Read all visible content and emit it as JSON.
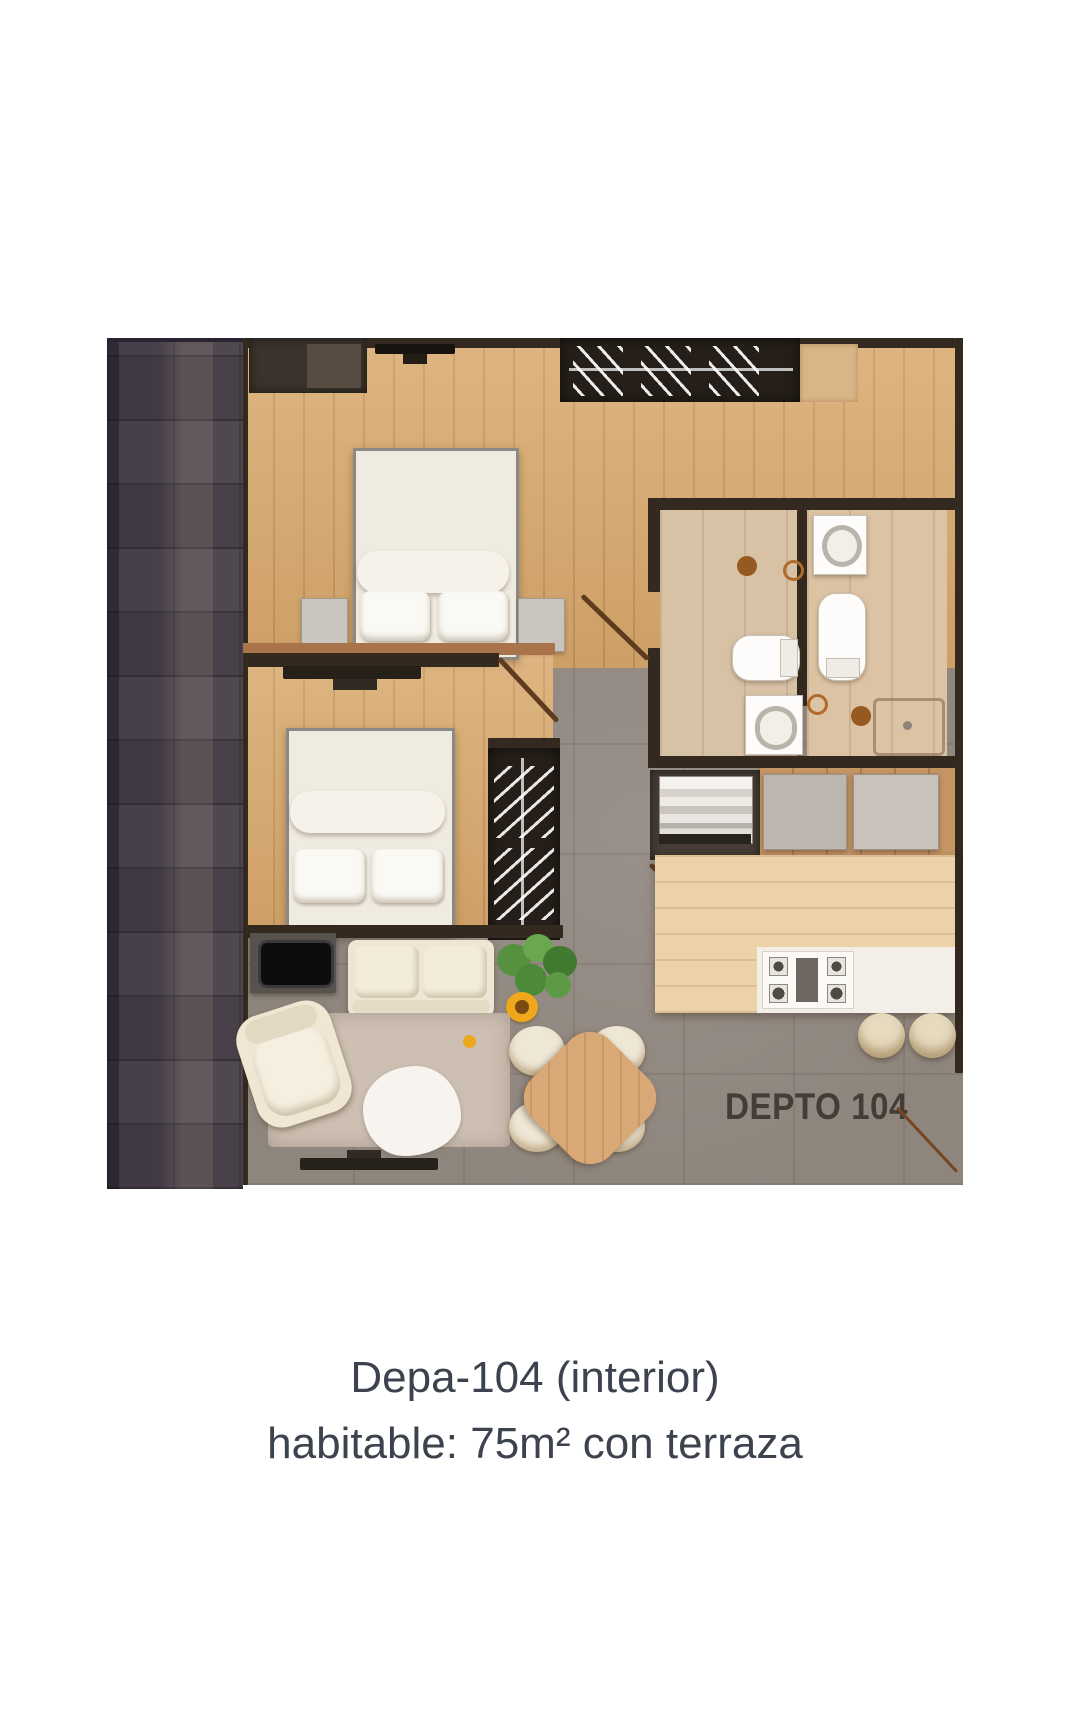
{
  "plan": {
    "unit_label": "DEPTO 104",
    "palette": {
      "wood_floor": "#d9a96c",
      "concrete_floor": "#8e857d",
      "bath_tile": "#d8c2a6",
      "wall": "#33291f",
      "terrace_dark": "#4d4550",
      "island_counter": "#ecd2a9",
      "marble": "#f3efe8",
      "plant_green": "#55913f",
      "flower_yellow": "#efa71d",
      "door_brown": "#5e3a1f"
    },
    "rooms": [
      "bedroom-1",
      "bedroom-2",
      "bathroom-1",
      "bathroom-2",
      "kitchen",
      "living-room",
      "dining-area",
      "entry-closet",
      "laundry-closet",
      "terrace-wall"
    ],
    "furniture_icons": [
      "double-bed-icon",
      "double-bed-icon",
      "hanger-rack-icon",
      "hanger-rack-icon",
      "toilet-icon",
      "toilet-icon",
      "sink-icon",
      "sink-icon",
      "shower-tray-icon",
      "washing-machine-icon",
      "fridge-icon",
      "stove-burners-icon",
      "kitchen-island-icon",
      "bar-stool-icon",
      "bar-stool-icon",
      "sofa-icon",
      "armchair-icon",
      "tv-icon",
      "tv-mount-icon",
      "rug-icon",
      "sheepskin-icon",
      "plant-icon",
      "sunflower-icon",
      "dining-table-icon",
      "dining-chair-icon"
    ]
  },
  "caption": {
    "line1": "Depa-104 (interior)",
    "line2": "habitable: 75m² con terraza"
  }
}
